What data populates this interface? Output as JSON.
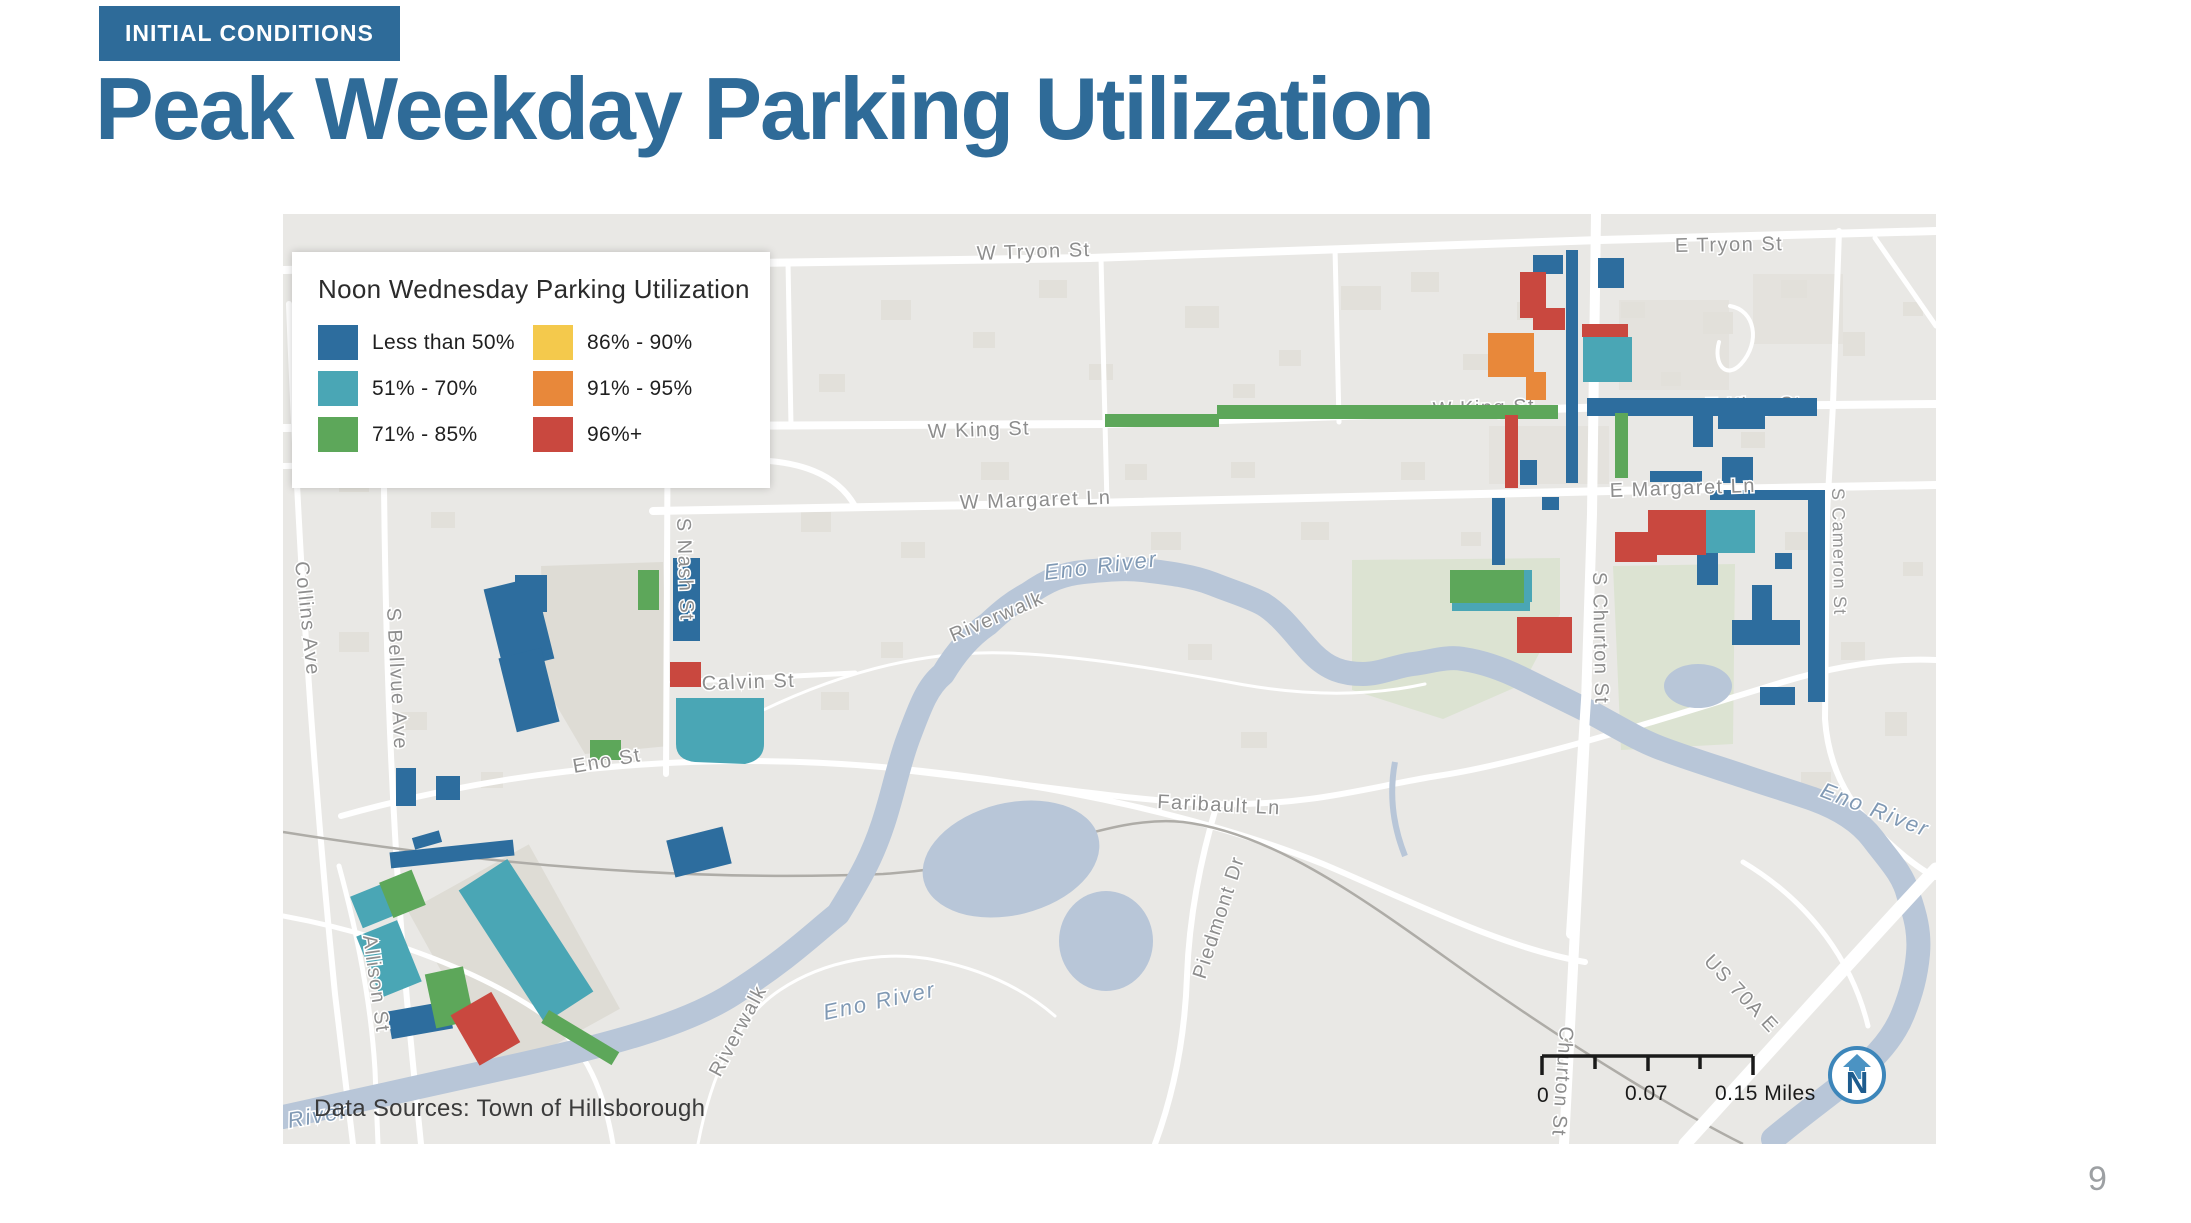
{
  "slide": {
    "badge": "INITIAL CONDITIONS",
    "title": "Peak Weekday Parking Utilization",
    "page_number": "9"
  },
  "legend": {
    "title": "Noon Wednesday Parking Utilization",
    "items": [
      {
        "label": "Less than 50%",
        "color": "#2d6d9e"
      },
      {
        "label": "51% - 70%",
        "color": "#4aa6b5"
      },
      {
        "label": "71% - 85%",
        "color": "#5da75a"
      },
      {
        "label": "86% - 90%",
        "color": "#f4c94c"
      },
      {
        "label": "91% - 95%",
        "color": "#e8883a"
      },
      {
        "label": "96%+",
        "color": "#c9483f"
      }
    ]
  },
  "map": {
    "data_source": "Data Sources: Town of Hillsborough",
    "scale": {
      "start": "0",
      "mid": "0.07",
      "end": "0.15 Miles"
    },
    "north_label": "N",
    "labels": [
      {
        "text": "W Tryon St"
      },
      {
        "text": "E Tryon St"
      },
      {
        "text": "W King St"
      },
      {
        "text": "W King St"
      },
      {
        "text": "E King St"
      },
      {
        "text": "W Margaret Ln"
      },
      {
        "text": "E Margaret Ln"
      },
      {
        "text": "Eno River"
      },
      {
        "text": "Riverwalk"
      },
      {
        "text": "Faribault Ln"
      },
      {
        "text": "Piedmont Dr"
      },
      {
        "text": "Collins Ave"
      },
      {
        "text": "S Bellvue Ave"
      },
      {
        "text": "S Nash St"
      },
      {
        "text": "Calvin St"
      },
      {
        "text": "Eno St"
      },
      {
        "text": "Allison St"
      },
      {
        "text": "Riverwalk"
      },
      {
        "text": "Eno River"
      },
      {
        "text": "River"
      },
      {
        "text": "S Churton St"
      },
      {
        "text": "Churton St"
      },
      {
        "text": "S Cameron St"
      },
      {
        "text": "US 70A E"
      },
      {
        "text": "Eno River"
      }
    ]
  }
}
